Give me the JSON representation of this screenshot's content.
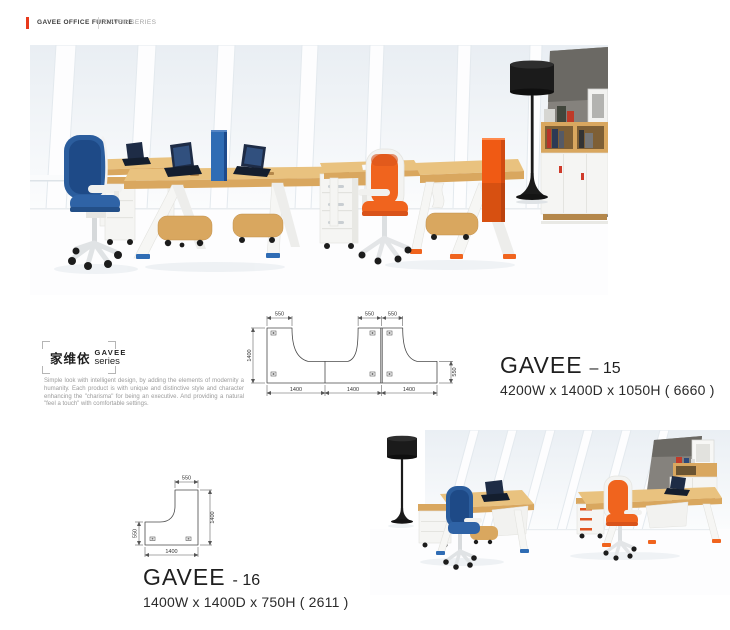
{
  "header": {
    "brand": "GAVEE OFFICE FURNITURE",
    "series": "GAVEE SERIES"
  },
  "intro": {
    "logo_cn": "家维依",
    "logo_en": "GAVEE",
    "logo_sub": "series",
    "description": "Simple look with intelligent design, by adding the elements of modernity a humanity. Each product is with unique and distinctive style and character enhancing the \"charisma\" for being an executive. And providing a natural \"feel a touch\" with comfortable settings."
  },
  "products": [
    {
      "name": "GAVEE",
      "model": "– 15",
      "dimensions": "4200W x 1400D x 1050H  ( 6660 )",
      "drawing": {
        "top_dims": [
          "550",
          "550",
          "550"
        ],
        "left_dim": "1400",
        "right_dim": "550",
        "bottom_dims": [
          "1400",
          "1400",
          "1400"
        ]
      }
    },
    {
      "name": "GAVEE",
      "model": "- 16",
      "dimensions": "1400W x 1400D x 750H  ( 2611 )",
      "drawing": {
        "top_dim": "550",
        "left_dim": "550",
        "right_dim": "1400",
        "bottom_dim": "1400"
      }
    }
  ],
  "colors": {
    "accent_red": "#e8391c",
    "text_dark": "#1f1f1f",
    "text_gray": "#9b9b9b",
    "wood": "#d9a75f",
    "wood_light": "#e9c27f",
    "wood_dark": "#b4874a",
    "chair_blue": "#2b5d9d",
    "chair_orange": "#f0641e",
    "divider_blue": "#2f6cb4",
    "divider_orange": "#f05a14",
    "lamp_black": "#1b1b1b",
    "wall_gray": "#85827d",
    "wall_gray_dark": "#6b6964",
    "furniture_white": "#f5f5f3"
  }
}
